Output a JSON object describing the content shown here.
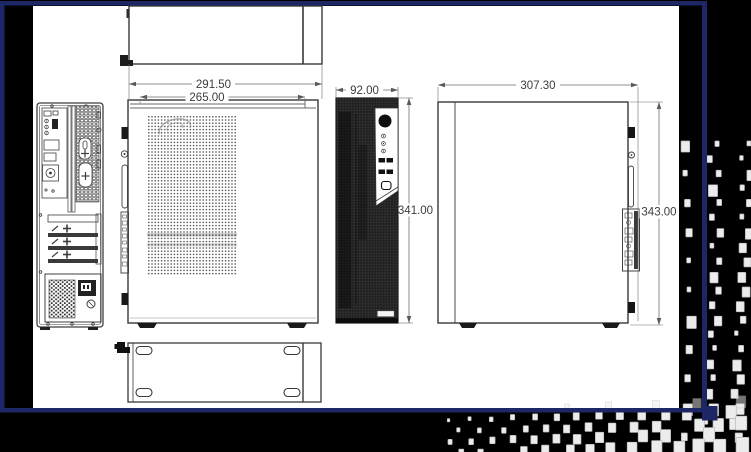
{
  "drawing": {
    "dimensions": {
      "top_width": "291.50",
      "chassis_width": "265.00",
      "front_width": "92.00",
      "front_height": "341.00",
      "side_depth": "307.30",
      "side_height": "343.00"
    }
  },
  "colors": {
    "frame_navy": "#1e2766",
    "background": "#000000",
    "paper": "#ffffff",
    "line": "#3f3f3f",
    "dim_line": "#6e6e6e",
    "checker_fill": "#ececec"
  }
}
